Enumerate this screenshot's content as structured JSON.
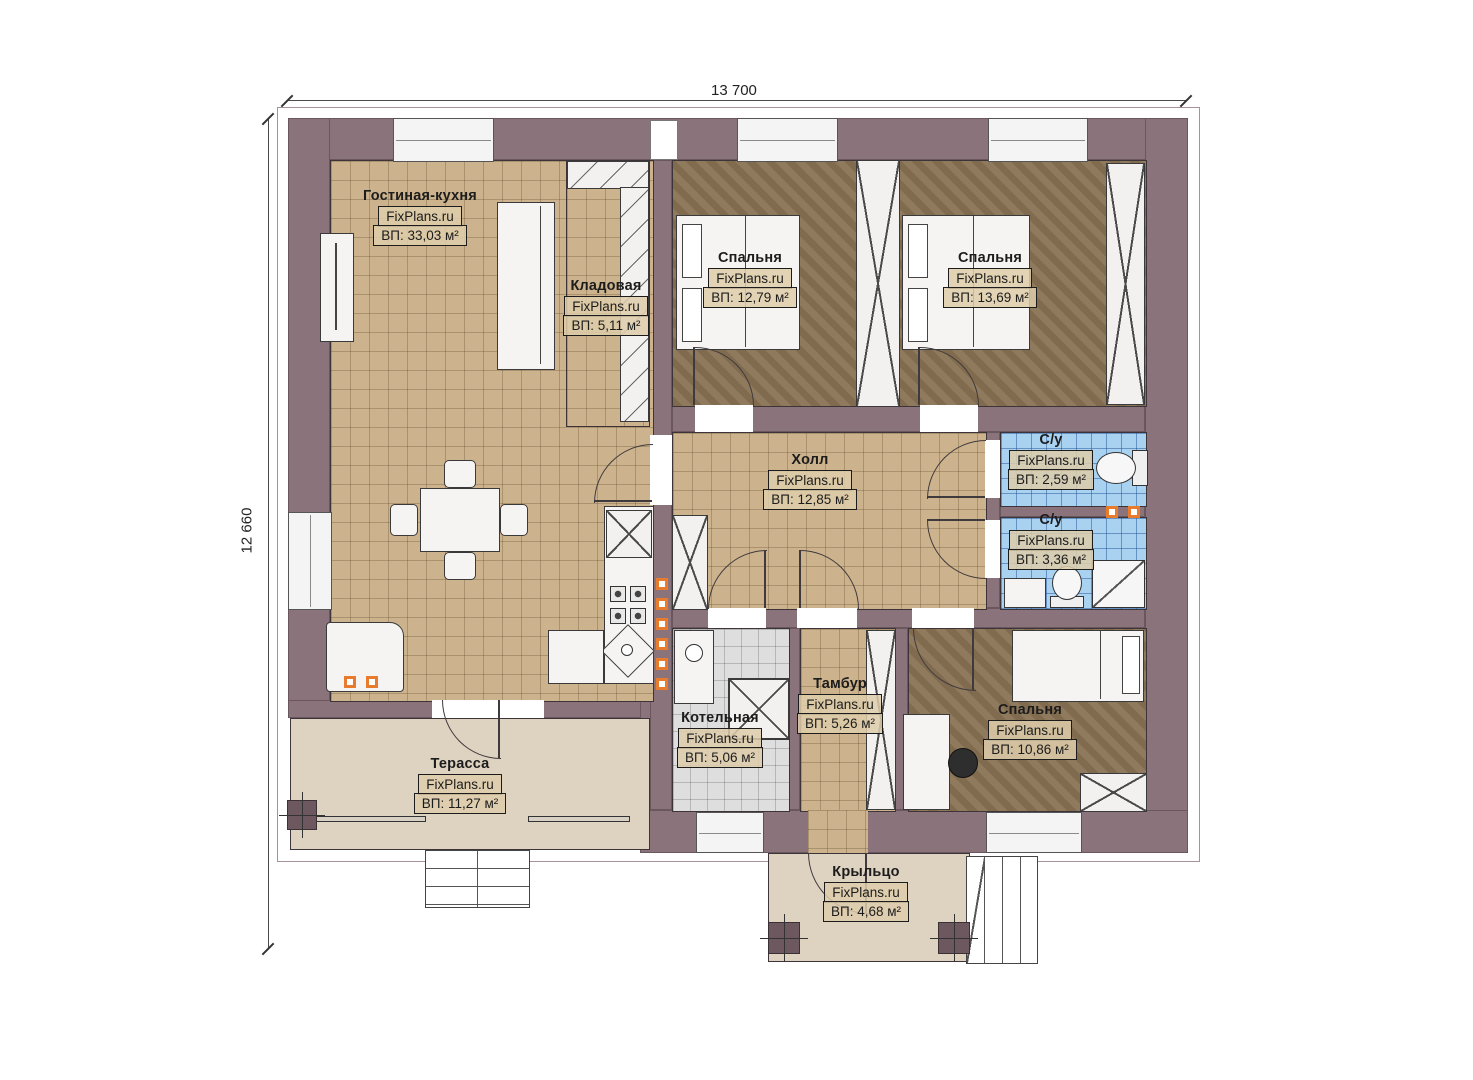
{
  "dimensions": {
    "width": "13 700",
    "height": "12 660"
  },
  "brand": "FixPlans.ru",
  "rooms": [
    {
      "id": "living-kitchen",
      "name": "Гостиная-кухня",
      "watermark": "FixPlans.ru",
      "area": "ВП: 33,03 м²"
    },
    {
      "id": "storage",
      "name": "Кладовая",
      "watermark": "FixPlans.ru",
      "area": "ВП: 5,11 м²"
    },
    {
      "id": "bedroom-1",
      "name": "Спальня",
      "watermark": "FixPlans.ru",
      "area": "ВП: 12,79 м²"
    },
    {
      "id": "bedroom-2",
      "name": "Спальня",
      "watermark": "FixPlans.ru",
      "area": "ВП: 13,69 м²"
    },
    {
      "id": "hall",
      "name": "Холл",
      "watermark": "FixPlans.ru",
      "area": "ВП: 12,85 м²"
    },
    {
      "id": "bathroom-1",
      "name": "С/у",
      "watermark": "FixPlans.ru",
      "area": "ВП: 2,59 м²"
    },
    {
      "id": "bathroom-2",
      "name": "С/у",
      "watermark": "FixPlans.ru",
      "area": "ВП: 3,36 м²"
    },
    {
      "id": "boiler-room",
      "name": "Котельная",
      "watermark": "FixPlans.ru",
      "area": "ВП: 5,06 м²"
    },
    {
      "id": "vestibule",
      "name": "Тамбур",
      "watermark": "FixPlans.ru",
      "area": "ВП: 5,26 м²"
    },
    {
      "id": "bedroom-3",
      "name": "Спальня",
      "watermark": "FixPlans.ru",
      "area": "ВП: 10,86 м²"
    },
    {
      "id": "terrace",
      "name": "Терасса",
      "watermark": "FixPlans.ru",
      "area": "ВП: 11,27 м²"
    },
    {
      "id": "porch",
      "name": "Крыльцо",
      "watermark": "FixPlans.ru",
      "area": "ВП: 4,68 м²"
    }
  ],
  "colors": {
    "wall": "#8b737b",
    "floor_tan": "#cdb38d",
    "floor_brown": "#8a7355",
    "floor_blue": "#a9d1f0",
    "floor_gray": "#dedede",
    "floor_beige": "#ded2c1",
    "accent_orange": "#e87c2e"
  }
}
